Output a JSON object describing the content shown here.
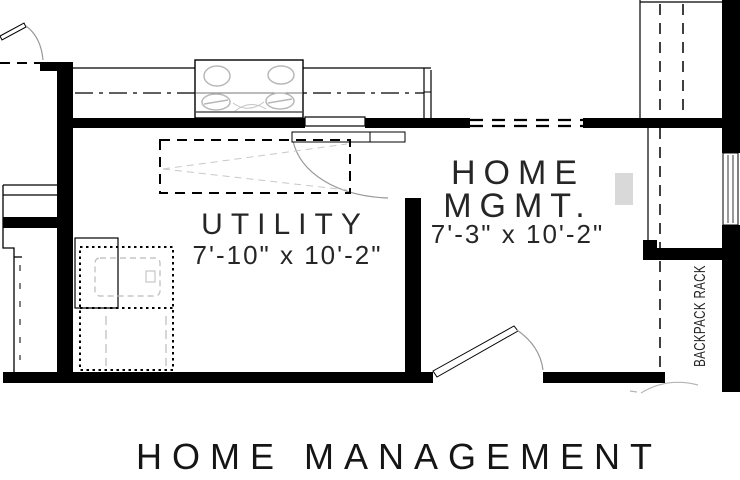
{
  "plan": {
    "rooms": {
      "utility": {
        "name": "UTILITY",
        "dimensions": "7'-10\" x 10'-2\""
      },
      "home_mgmt": {
        "line1": "HOME",
        "line2": "MGMT.",
        "dimensions": "7'-3\" x 10'-2\""
      }
    },
    "labels": {
      "backpack_rack": "BACKPACK RACK"
    },
    "title": "HOME MANAGEMENT"
  },
  "colors": {
    "background": "#ffffff",
    "wall": "#000000",
    "text": "#1f1f1f",
    "light_detail": "#b5b5b5",
    "faint_detail": "#c8c8c8",
    "shaded_niche": "#d9d9d9"
  }
}
